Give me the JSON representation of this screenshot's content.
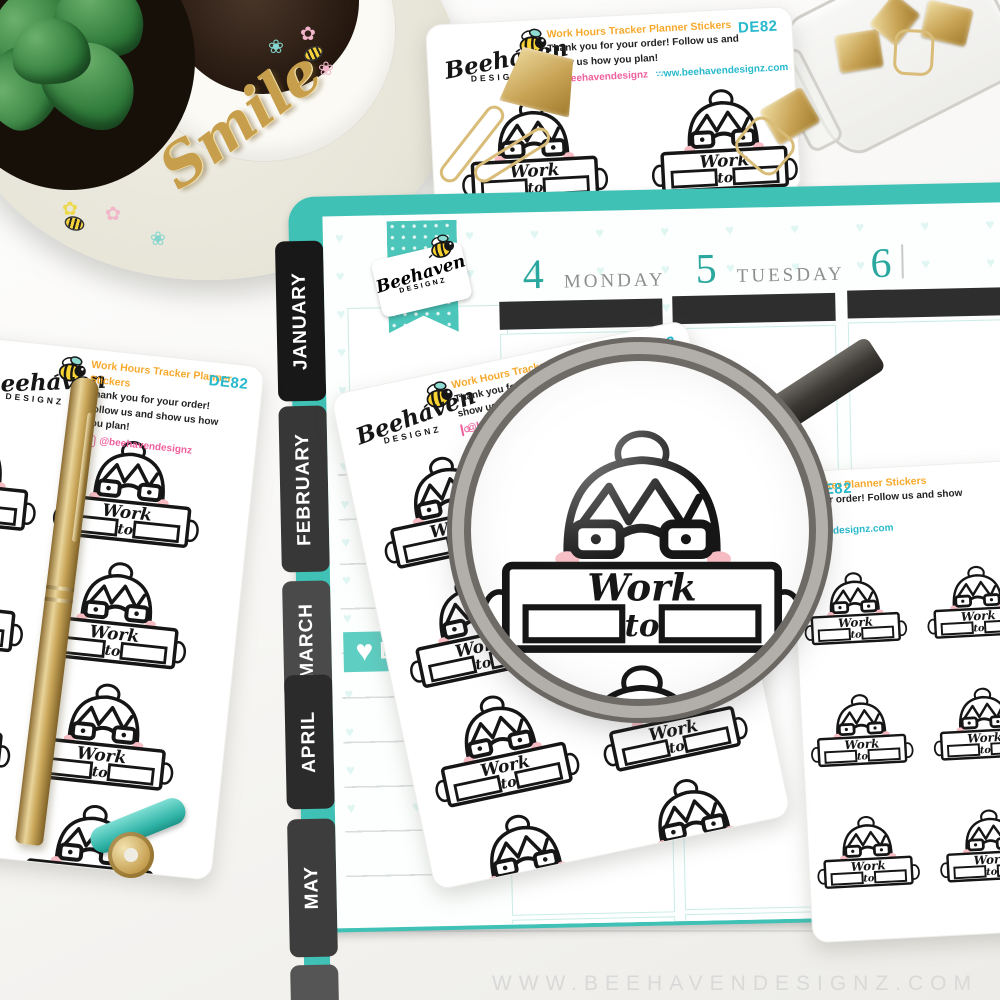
{
  "brand": {
    "script": "Beehaven",
    "caps": "DESIGNZ"
  },
  "sheet": {
    "code": "DE82",
    "title": "Work Hours Tracker Planner Stickers",
    "thanks": "Thank you for your order! Follow us and show us how you plan!",
    "instagram": "@beehavendesignz",
    "website": "www.beehavendesignz.com"
  },
  "sticker": {
    "word_top": "Work",
    "word_mid": "to"
  },
  "planner": {
    "tabs": [
      "JANUARY",
      "FEBRUARY",
      "MARCH",
      "APRIL",
      "MAY"
    ],
    "days": [
      {
        "number": "4",
        "name": "MONDAY"
      },
      {
        "number": "5",
        "name": "TUESDAY"
      },
      {
        "number": "6",
        "name": ""
      }
    ],
    "heart_strip_text": "B"
  },
  "props": {
    "smile_text": "Smile"
  },
  "watermark": "WWW.BEEHAVENDESIGNZ.COM",
  "colors": {
    "teal": "#3fc1b5",
    "cyan_text": "#28b9cc",
    "orange": "#f6a92c",
    "pink": "#f0609e",
    "gold": "#c7a256",
    "tab_black": "#1d1d1d",
    "day_teal": "#2aa79e",
    "skin": "#f2c4ad"
  }
}
